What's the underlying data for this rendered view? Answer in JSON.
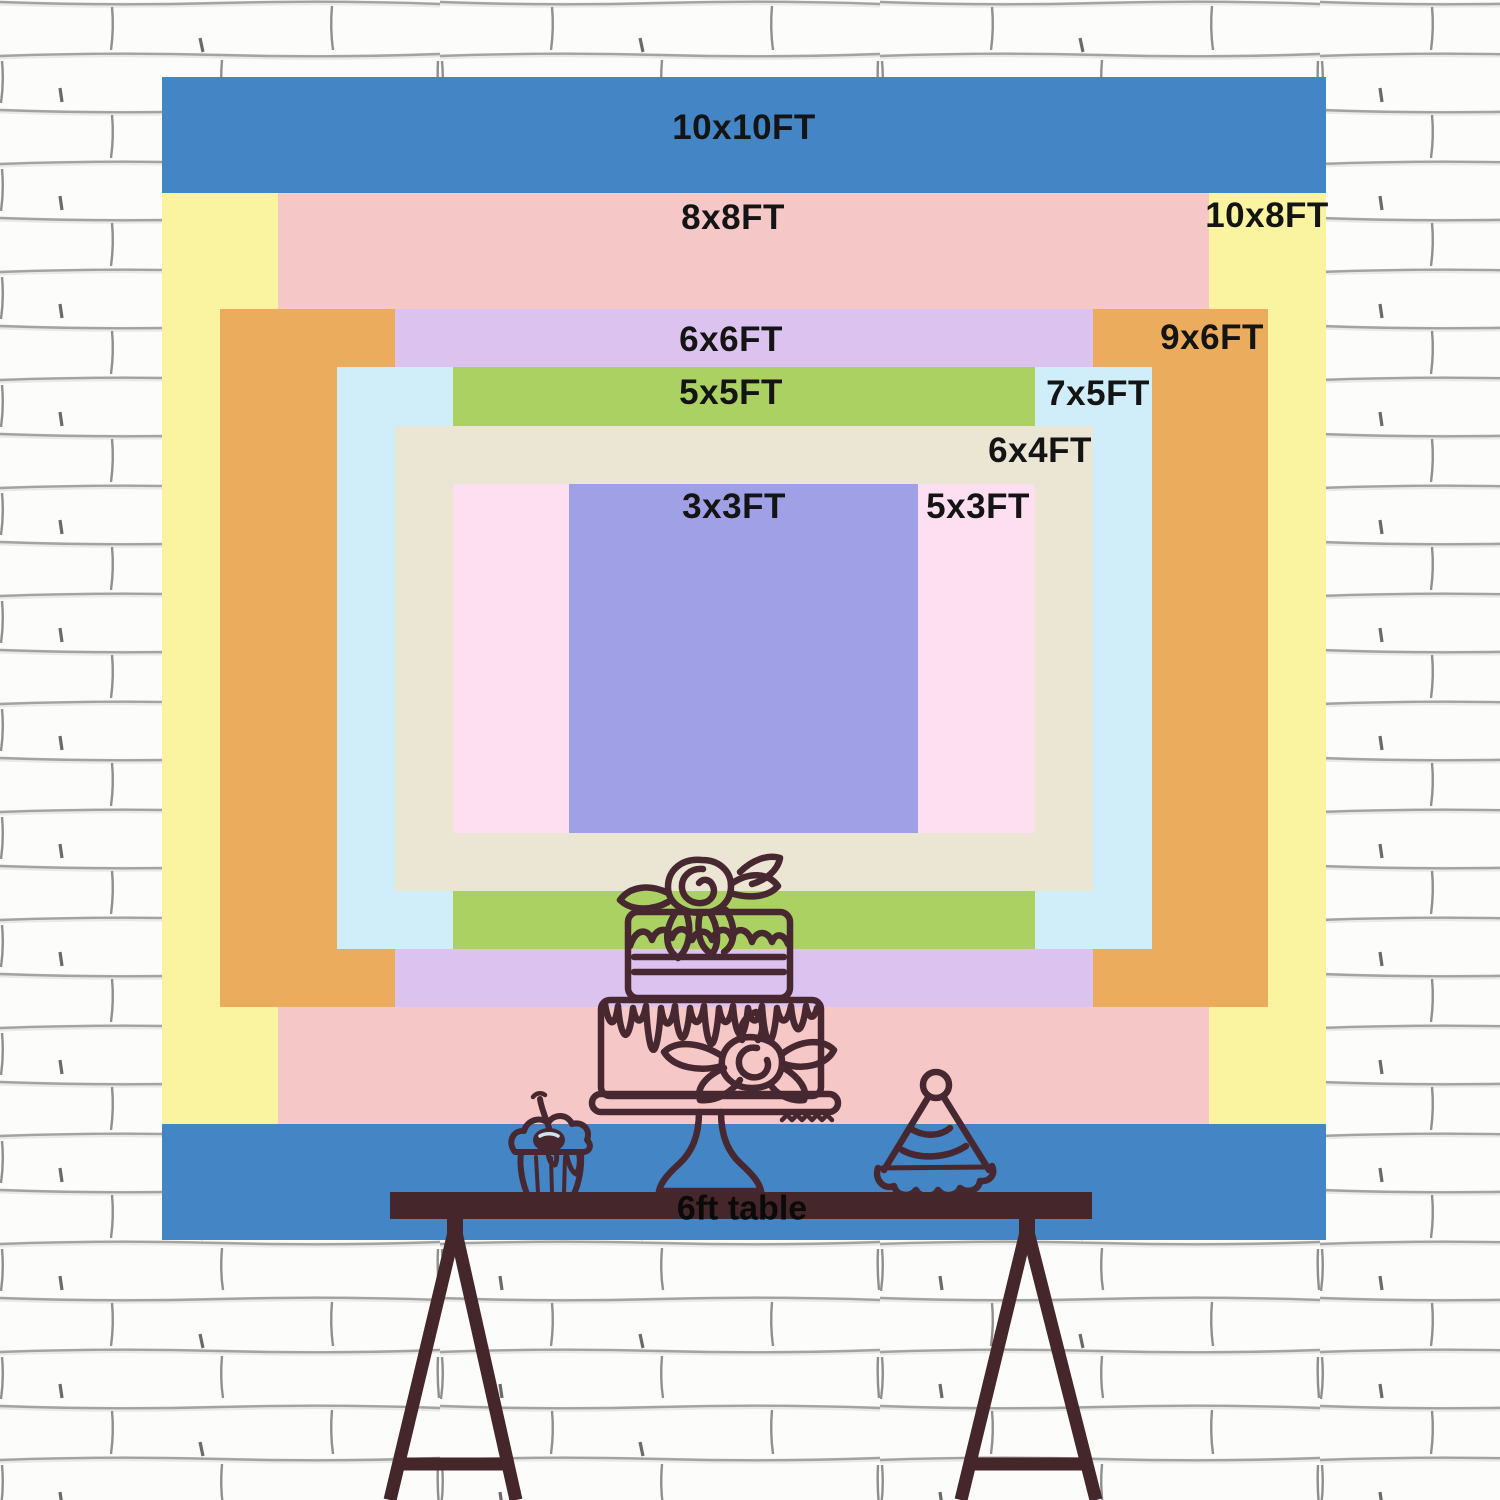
{
  "sizes": [
    {
      "label": "10x10FT",
      "color": "#4485c5",
      "width_ft": 10,
      "height_ft": 10
    },
    {
      "label": "10x8FT",
      "color": "#faf4a1",
      "width_ft": 10,
      "height_ft": 8
    },
    {
      "label": "8x8FT",
      "color": "#f5c7c7",
      "width_ft": 8,
      "height_ft": 8
    },
    {
      "label": "9x6FT",
      "color": "#ecac5e",
      "width_ft": 9,
      "height_ft": 6
    },
    {
      "label": "6x6FT",
      "color": "#dcc2ee",
      "width_ft": 6,
      "height_ft": 6
    },
    {
      "label": "7x5FT",
      "color": "#cfeefa",
      "width_ft": 7,
      "height_ft": 5
    },
    {
      "label": "5x5FT",
      "color": "#abd163",
      "width_ft": 5,
      "height_ft": 5
    },
    {
      "label": "6x4FT",
      "color": "#ebe5d4",
      "width_ft": 6,
      "height_ft": 4
    },
    {
      "label": "5x3FT",
      "color": "#fedff2",
      "width_ft": 5,
      "height_ft": 3
    },
    {
      "label": "3x3FT",
      "color": "#a0a0e6",
      "width_ft": 3,
      "height_ft": 3
    }
  ],
  "table": {
    "label": "6ft table",
    "color": "#45262a"
  },
  "decorations": {
    "icons": [
      "cake-icon",
      "cupcake-icon",
      "party-hat-icon"
    ],
    "line_color": "#472830"
  },
  "wall": {
    "base_color": "#fcfcfb",
    "mortar_line_color": "#a3a3a3"
  }
}
